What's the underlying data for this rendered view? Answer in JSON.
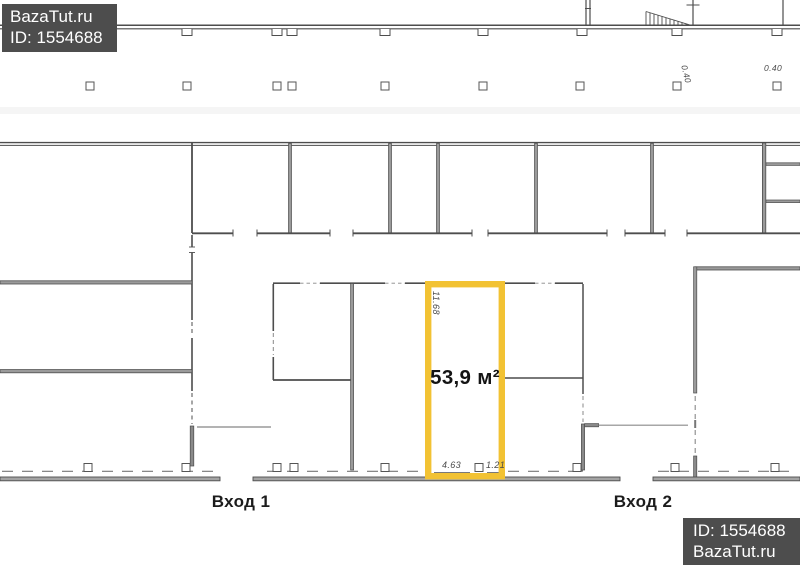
{
  "watermarks": {
    "top": {
      "site": "BazaTut.ru",
      "id": "ID: 1554688"
    },
    "bottom": {
      "id": "ID: 1554688",
      "site": "BazaTut.ru"
    },
    "bg_color": "#4D4D4D",
    "text_color": "#FFFFFF"
  },
  "unit": {
    "area": "53,9 м²",
    "dim_side": "11.68",
    "dim_front": "4.63",
    "dim_column": "1.21",
    "highlight_color": "#F2C233"
  },
  "column_dims": {
    "left": "0.40",
    "right": "0.40"
  },
  "entrances": {
    "one": "Вход 1",
    "two": "Вход 2"
  },
  "plan_colors": {
    "wall_dark": "#4D4D4D",
    "wall_gray": "#9A9A9A"
  }
}
